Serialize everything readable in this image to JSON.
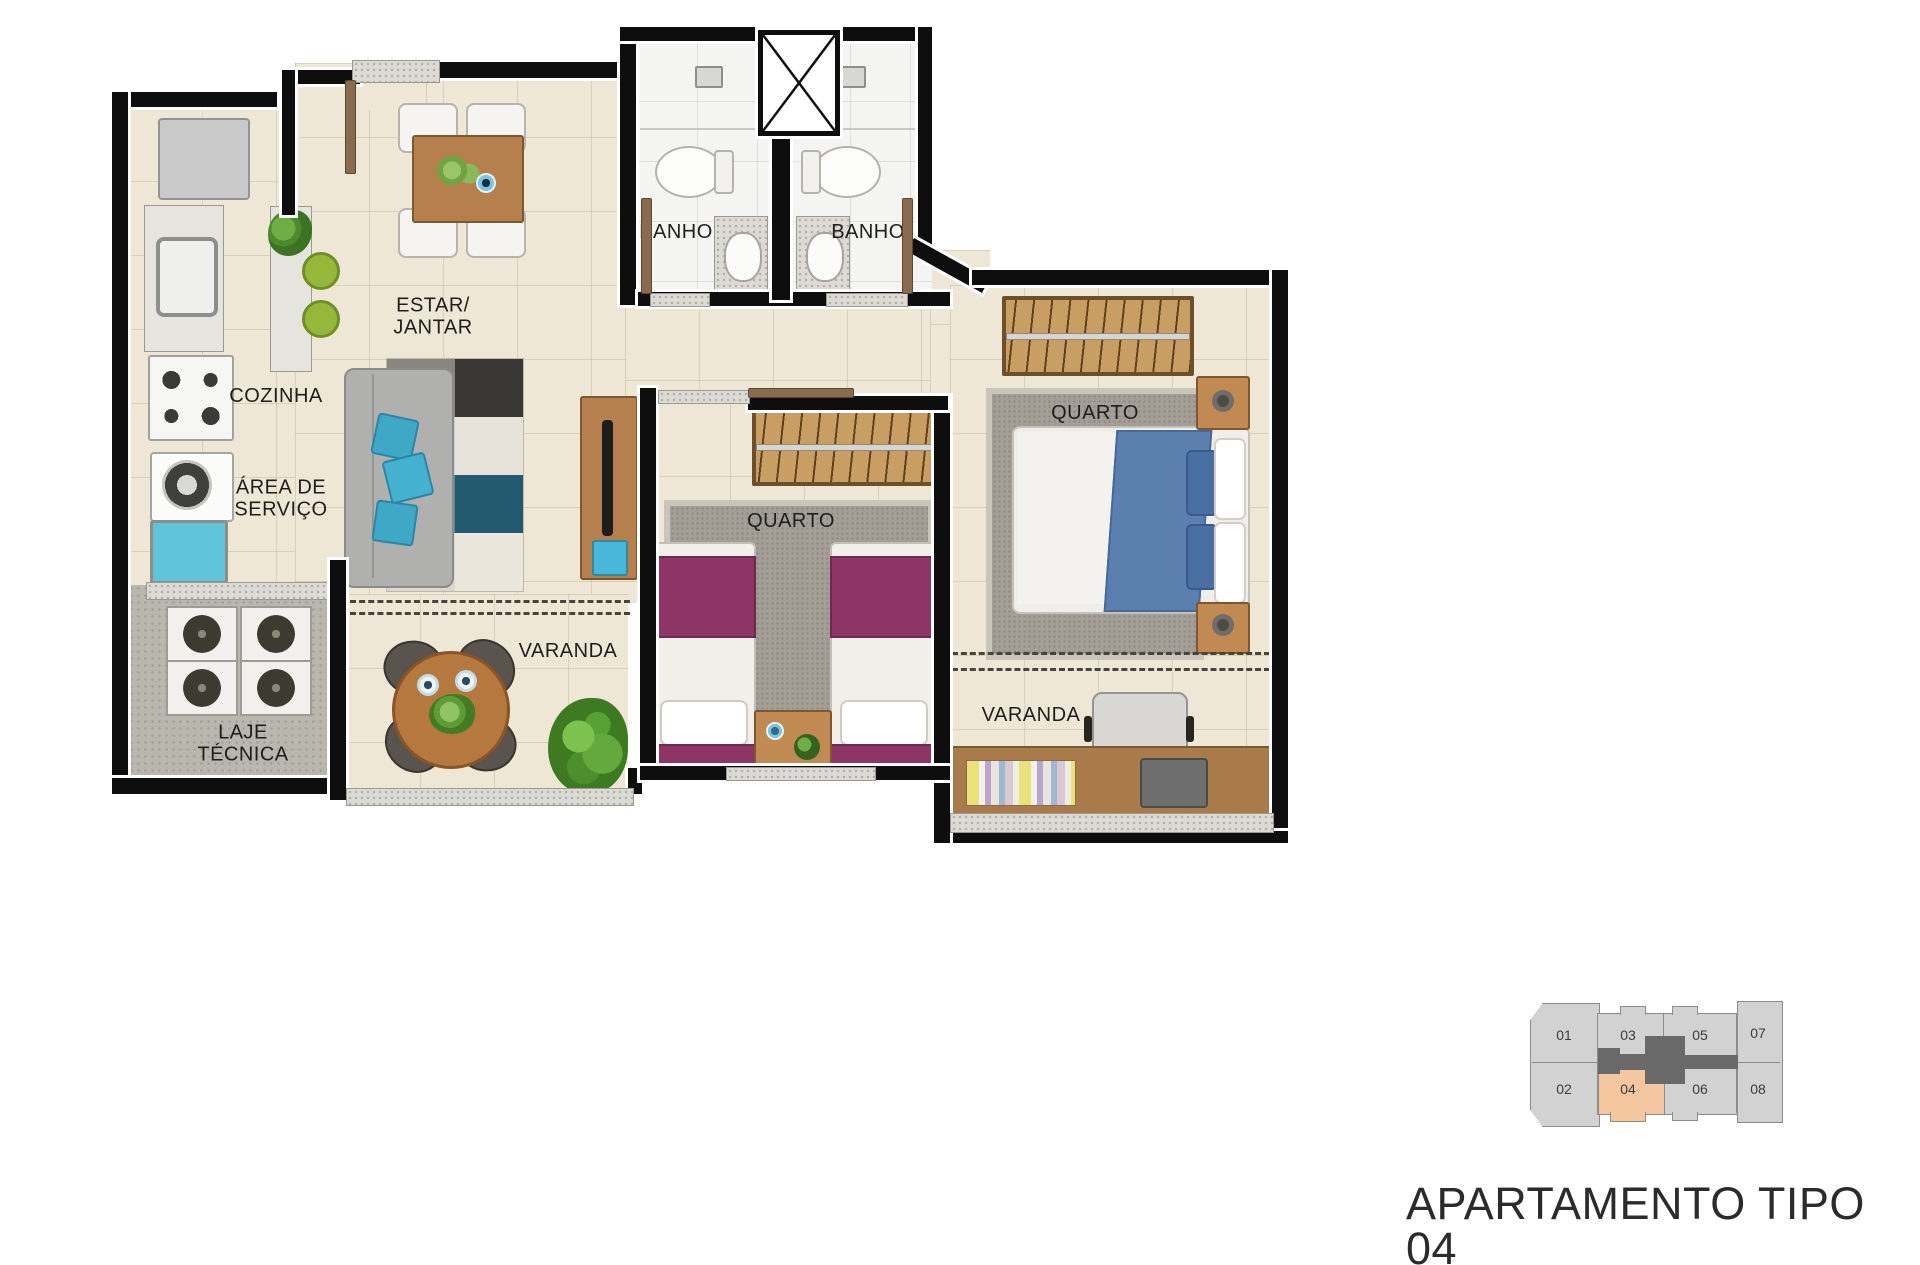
{
  "title": "APARTAMENTO TIPO 04",
  "plan": {
    "rooms": {
      "cozinha": "COZINHA",
      "area_servico_line1": "ÁREA DE",
      "area_servico_line2": "SERVIÇO",
      "laje_line1": "LAJE",
      "laje_line2": "TÉCNICA",
      "estar_line1": "ESTAR/",
      "estar_line2": "JANTAR",
      "banho_1": "BANHO",
      "banho_2": "BANHO",
      "quarto_middle": "QUARTO",
      "quarto_right": "QUARTO",
      "varanda_left": "VARANDA",
      "varanda_right": "VARANDA"
    }
  },
  "keyplan": {
    "units": [
      {
        "label": "01"
      },
      {
        "label": "03"
      },
      {
        "label": "05"
      },
      {
        "label": "07"
      },
      {
        "label": "02"
      },
      {
        "label": "04",
        "highlighted": true
      },
      {
        "label": "06"
      },
      {
        "label": "08"
      }
    ],
    "highlighted_unit": "04"
  },
  "colors": {
    "wall": "#0e0e0e",
    "floor": "#efe7d6",
    "highlight_unit": "#f4c7a1",
    "keyplan_building": "#d2d2d2",
    "keyplan_core": "#696969",
    "bedding_blue": "#5b80b0",
    "bedding_magenta": "#8e3566",
    "accent_teal": "#3fa8c7"
  }
}
